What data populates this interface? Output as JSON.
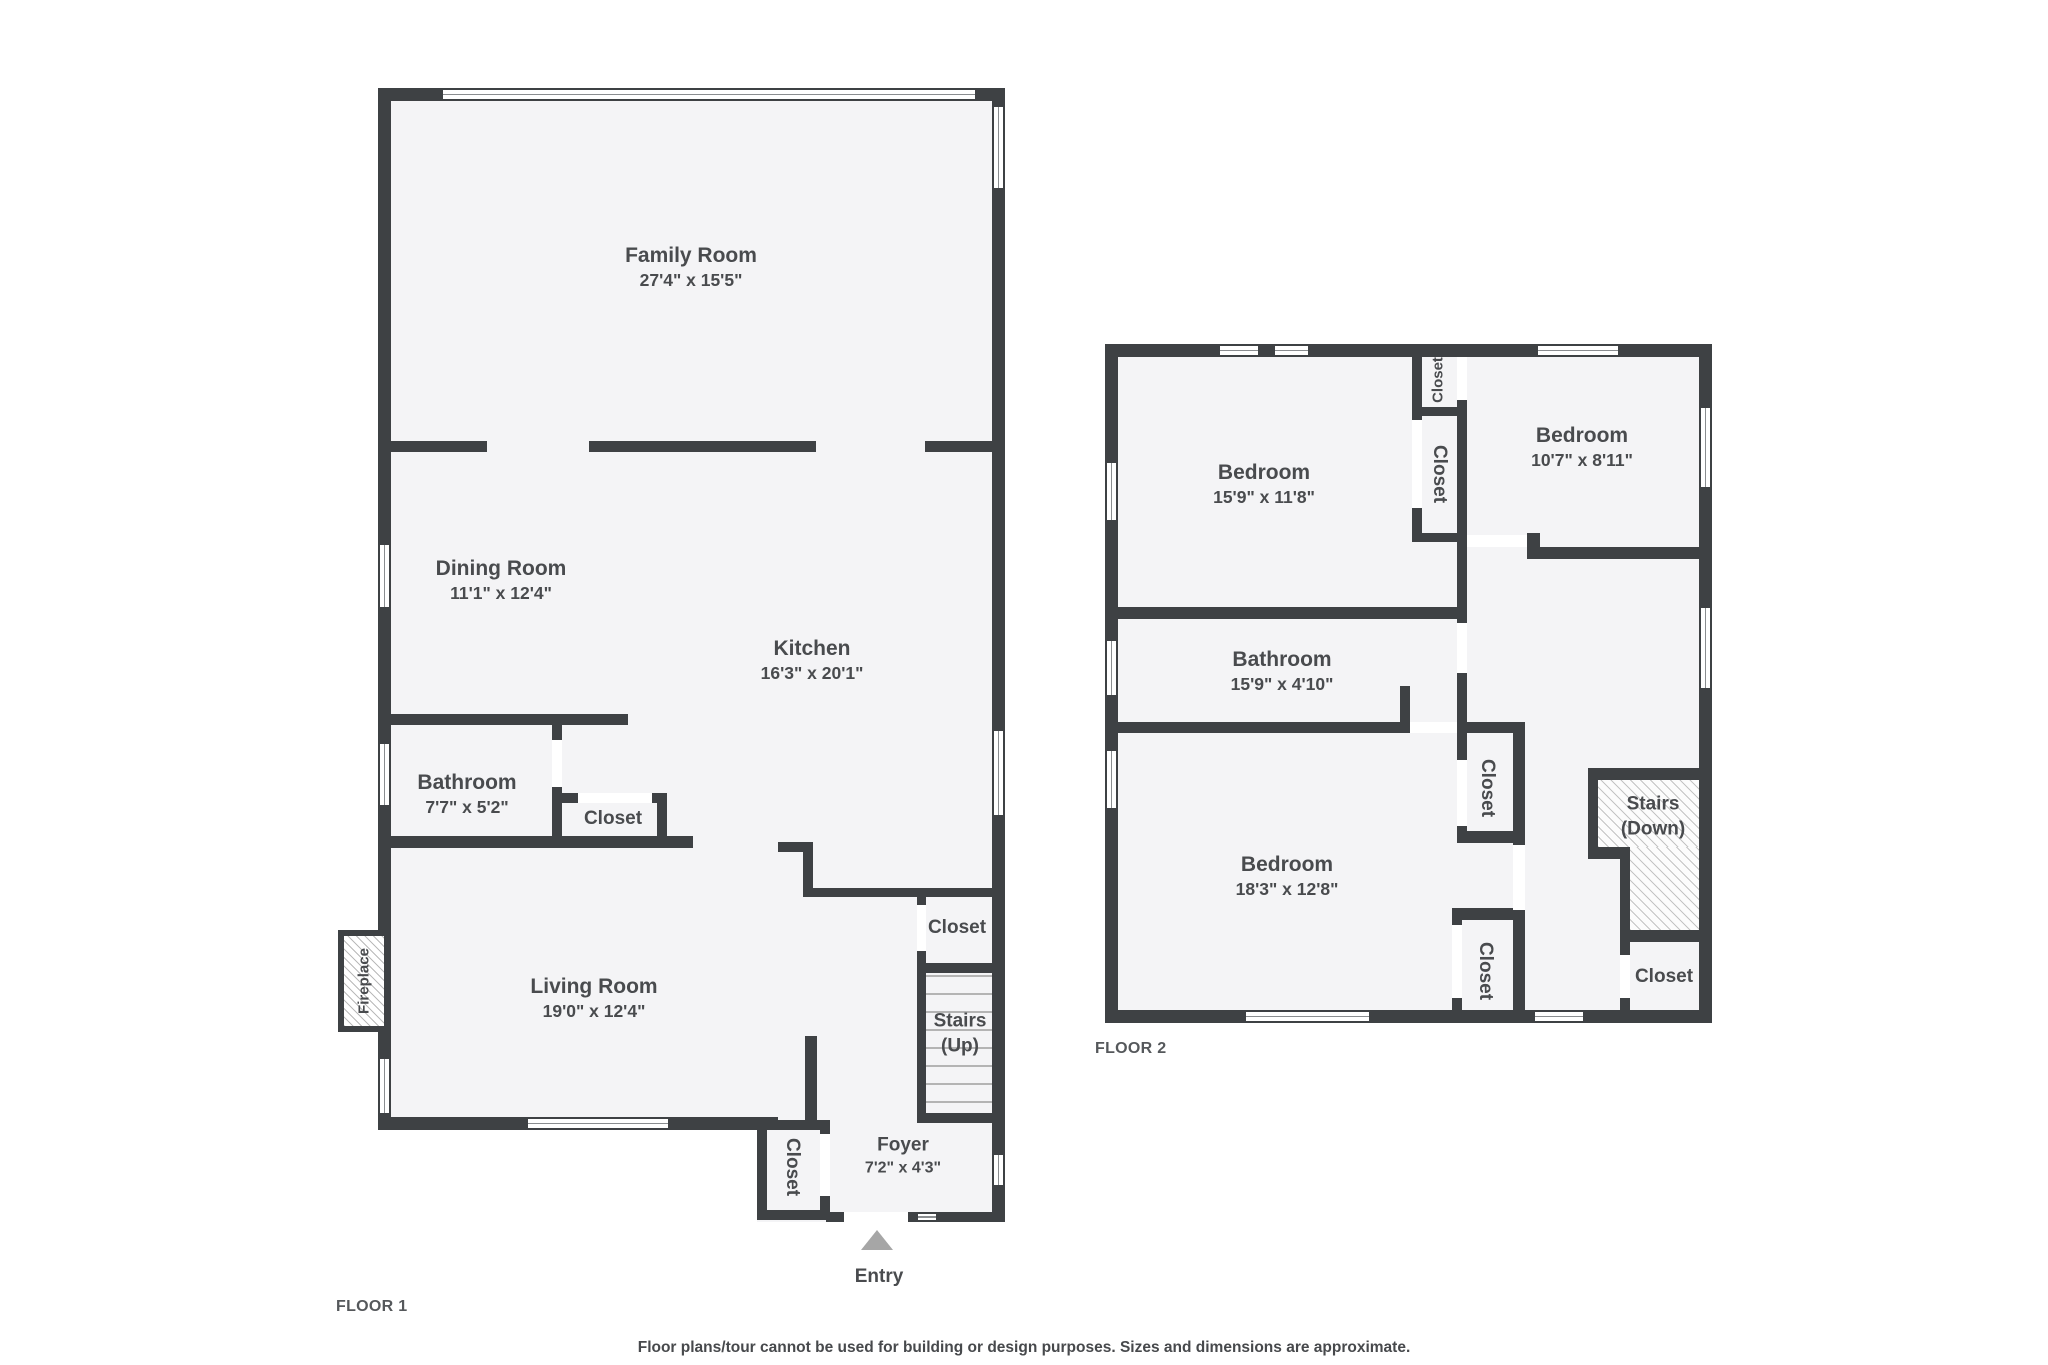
{
  "colors": {
    "wall": "#3e4144",
    "floor_fill": "#f4f4f6",
    "text": "#494b4e",
    "entry_arrow": "#a6a6a6"
  },
  "floor1": {
    "label": "FLOOR 1",
    "family_room": {
      "name": "Family Room",
      "dims": "27'4\" x 15'5\""
    },
    "dining_room": {
      "name": "Dining Room",
      "dims": "11'1\" x 12'4\""
    },
    "kitchen": {
      "name": "Kitchen",
      "dims": "16'3\" x 20'1\""
    },
    "bathroom": {
      "name": "Bathroom",
      "dims": "7'7\" x 5'2\""
    },
    "kitchen_closet": "Closet",
    "living_room": {
      "name": "Living Room",
      "dims": "19'0\" x 12'4\""
    },
    "fireplace": "Fireplace",
    "stair_closet": "Closet",
    "stairs": {
      "line1": "Stairs",
      "line2": "(Up)"
    },
    "foyer_closet": "Closet",
    "foyer": {
      "name": "Foyer",
      "dims": "7'2\" x 4'3\""
    },
    "entry": "Entry"
  },
  "floor2": {
    "label": "FLOOR 2",
    "bedroom1": {
      "name": "Bedroom",
      "dims": "15'9\" x 11'8\""
    },
    "closet_a": "Closet",
    "closet_b": "Closet",
    "bedroom2": {
      "name": "Bedroom",
      "dims": "10'7\" x 8'11\""
    },
    "bathroom": {
      "name": "Bathroom",
      "dims": "15'9\" x 4'10\""
    },
    "bedroom3": {
      "name": "Bedroom",
      "dims": "18'3\" x 12'8\""
    },
    "closet_c": "Closet",
    "closet_d": "Closet",
    "stairs": {
      "line1": "Stairs",
      "line2": "(Down)"
    },
    "closet_e": "Closet"
  },
  "footer": {
    "disclaimer": "Floor plans/tour cannot be used for building or design purposes. Sizes and dimensions are approximate."
  }
}
